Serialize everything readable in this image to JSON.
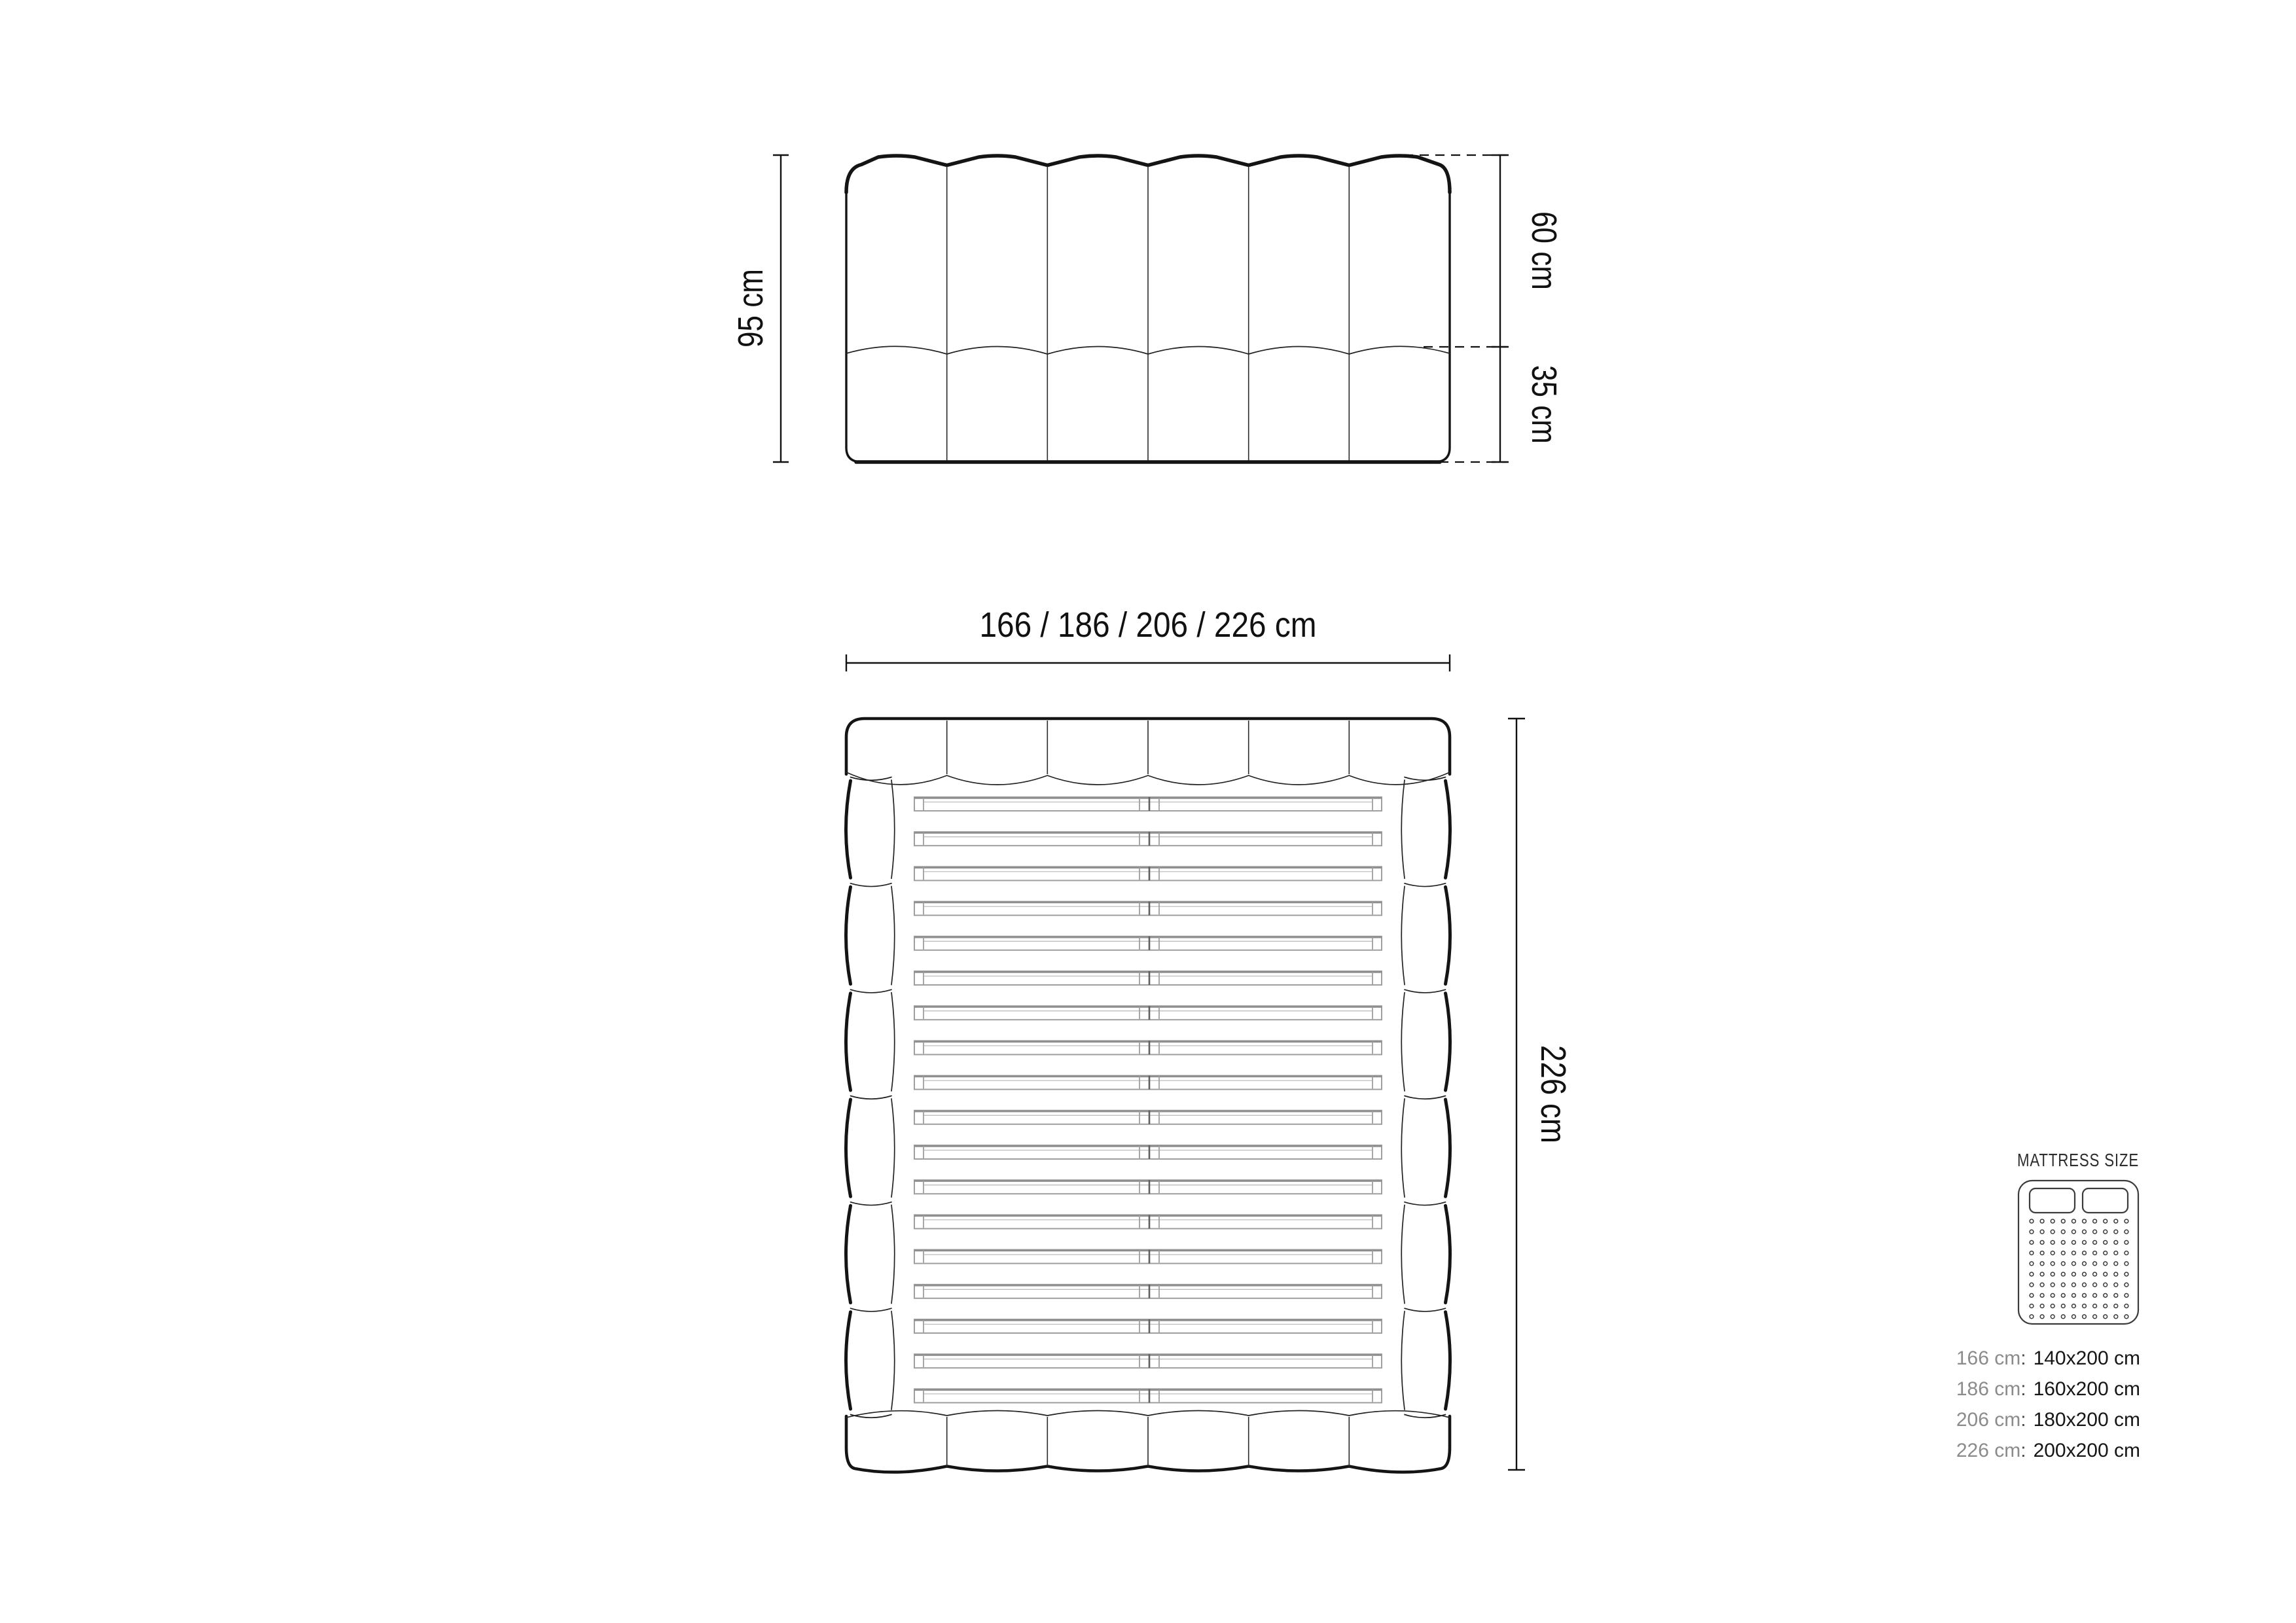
{
  "elevation": {
    "height_label": "95 cm",
    "headboard_label": "60 cm",
    "base_label": "35 cm",
    "channels": 6
  },
  "plan": {
    "width_label": "166 / 186 / 206 / 226 cm",
    "length_label": "226 cm",
    "channels": 6,
    "slat_count": 18,
    "side_segments_per_rail": 6
  },
  "mattress_panel": {
    "title": "MATTRESS SIZE",
    "colon": ":",
    "pillow_count": 2,
    "dot_grid": {
      "rows": 10,
      "cols": 10
    },
    "sizes": [
      {
        "frame": "166 cm",
        "mattress": "140x200 cm"
      },
      {
        "frame": "186 cm",
        "mattress": "160x200 cm"
      },
      {
        "frame": "206 cm",
        "mattress": "180x200 cm"
      },
      {
        "frame": "226 cm",
        "mattress": "200x200 cm"
      }
    ]
  },
  "colors": {
    "line": "#141414",
    "slat": "#9f9f9f",
    "muted_text": "#8b8b8b",
    "text": "#161616",
    "background": "#ffffff"
  }
}
